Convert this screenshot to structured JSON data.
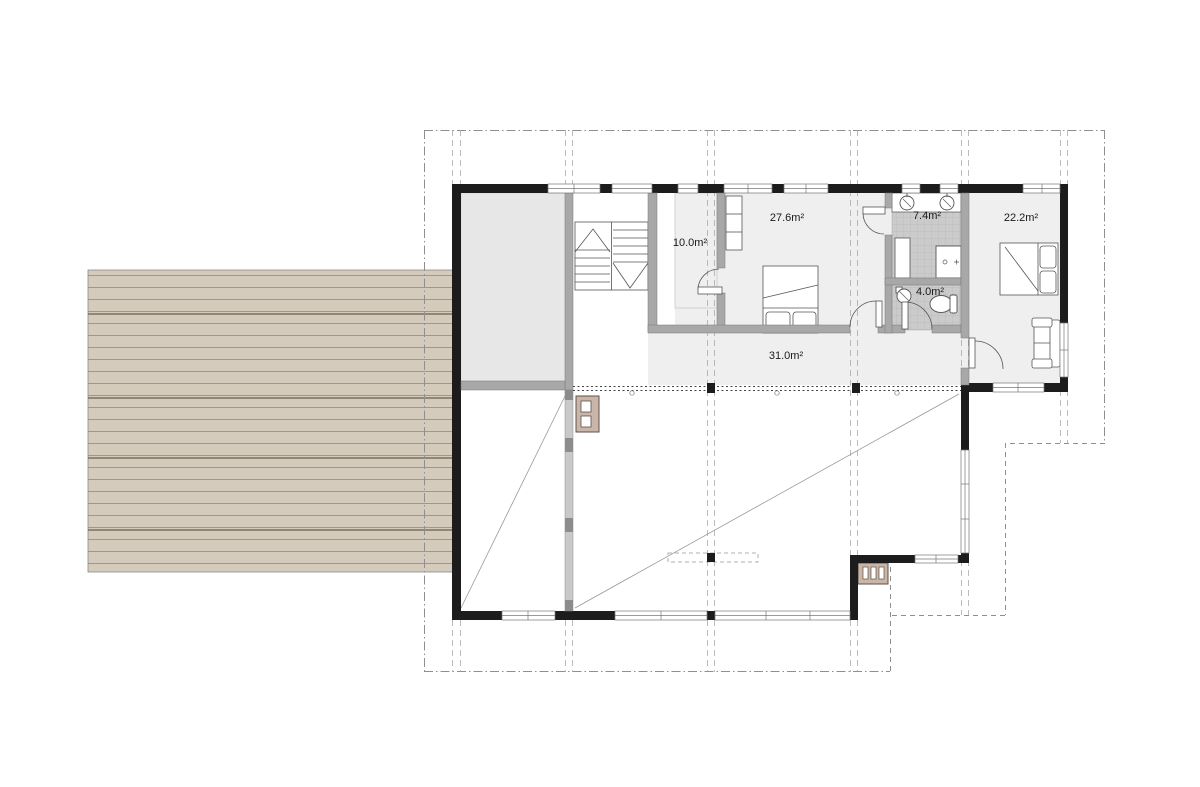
{
  "document": {
    "type": "architectural-floor-plan",
    "floor": "upper floor with gallery void and exterior deck"
  },
  "rooms": [
    {
      "name": "hall-closet",
      "area_label": "10.0m²"
    },
    {
      "name": "bedroom-1",
      "area_label": "27.6m²"
    },
    {
      "name": "bathroom",
      "area_label": "7.4m²"
    },
    {
      "name": "wc",
      "area_label": "4.0m²"
    },
    {
      "name": "bedroom-2",
      "area_label": "22.2m²"
    },
    {
      "name": "landing",
      "area_label": "31.0m²"
    }
  ],
  "symbols": [
    "stair-symbol",
    "double-bed-symbol",
    "wardrobe-symbol",
    "sofa-symbol",
    "washbasin-symbol",
    "toilet-symbol",
    "shower-symbol",
    "fireplace-flue-symbol",
    "door-swing",
    "window",
    "railing",
    "void-diagonal",
    "roof-outline",
    "grid-line",
    "deck"
  ],
  "colors": {
    "wall": "#1c1c1c",
    "partition": "#a8a8a8",
    "room_fill": "#efefef",
    "storage_fill": "#e7e7e7",
    "tile_fill": "#cbcbcb",
    "tile_line": "#b9b9b9",
    "deck_fill": "#d5cbbd",
    "deck_line": "#a59681",
    "flue_fill": "#c9b6a9",
    "dash_line": "#9a9a9a",
    "background": "#ffffff"
  }
}
